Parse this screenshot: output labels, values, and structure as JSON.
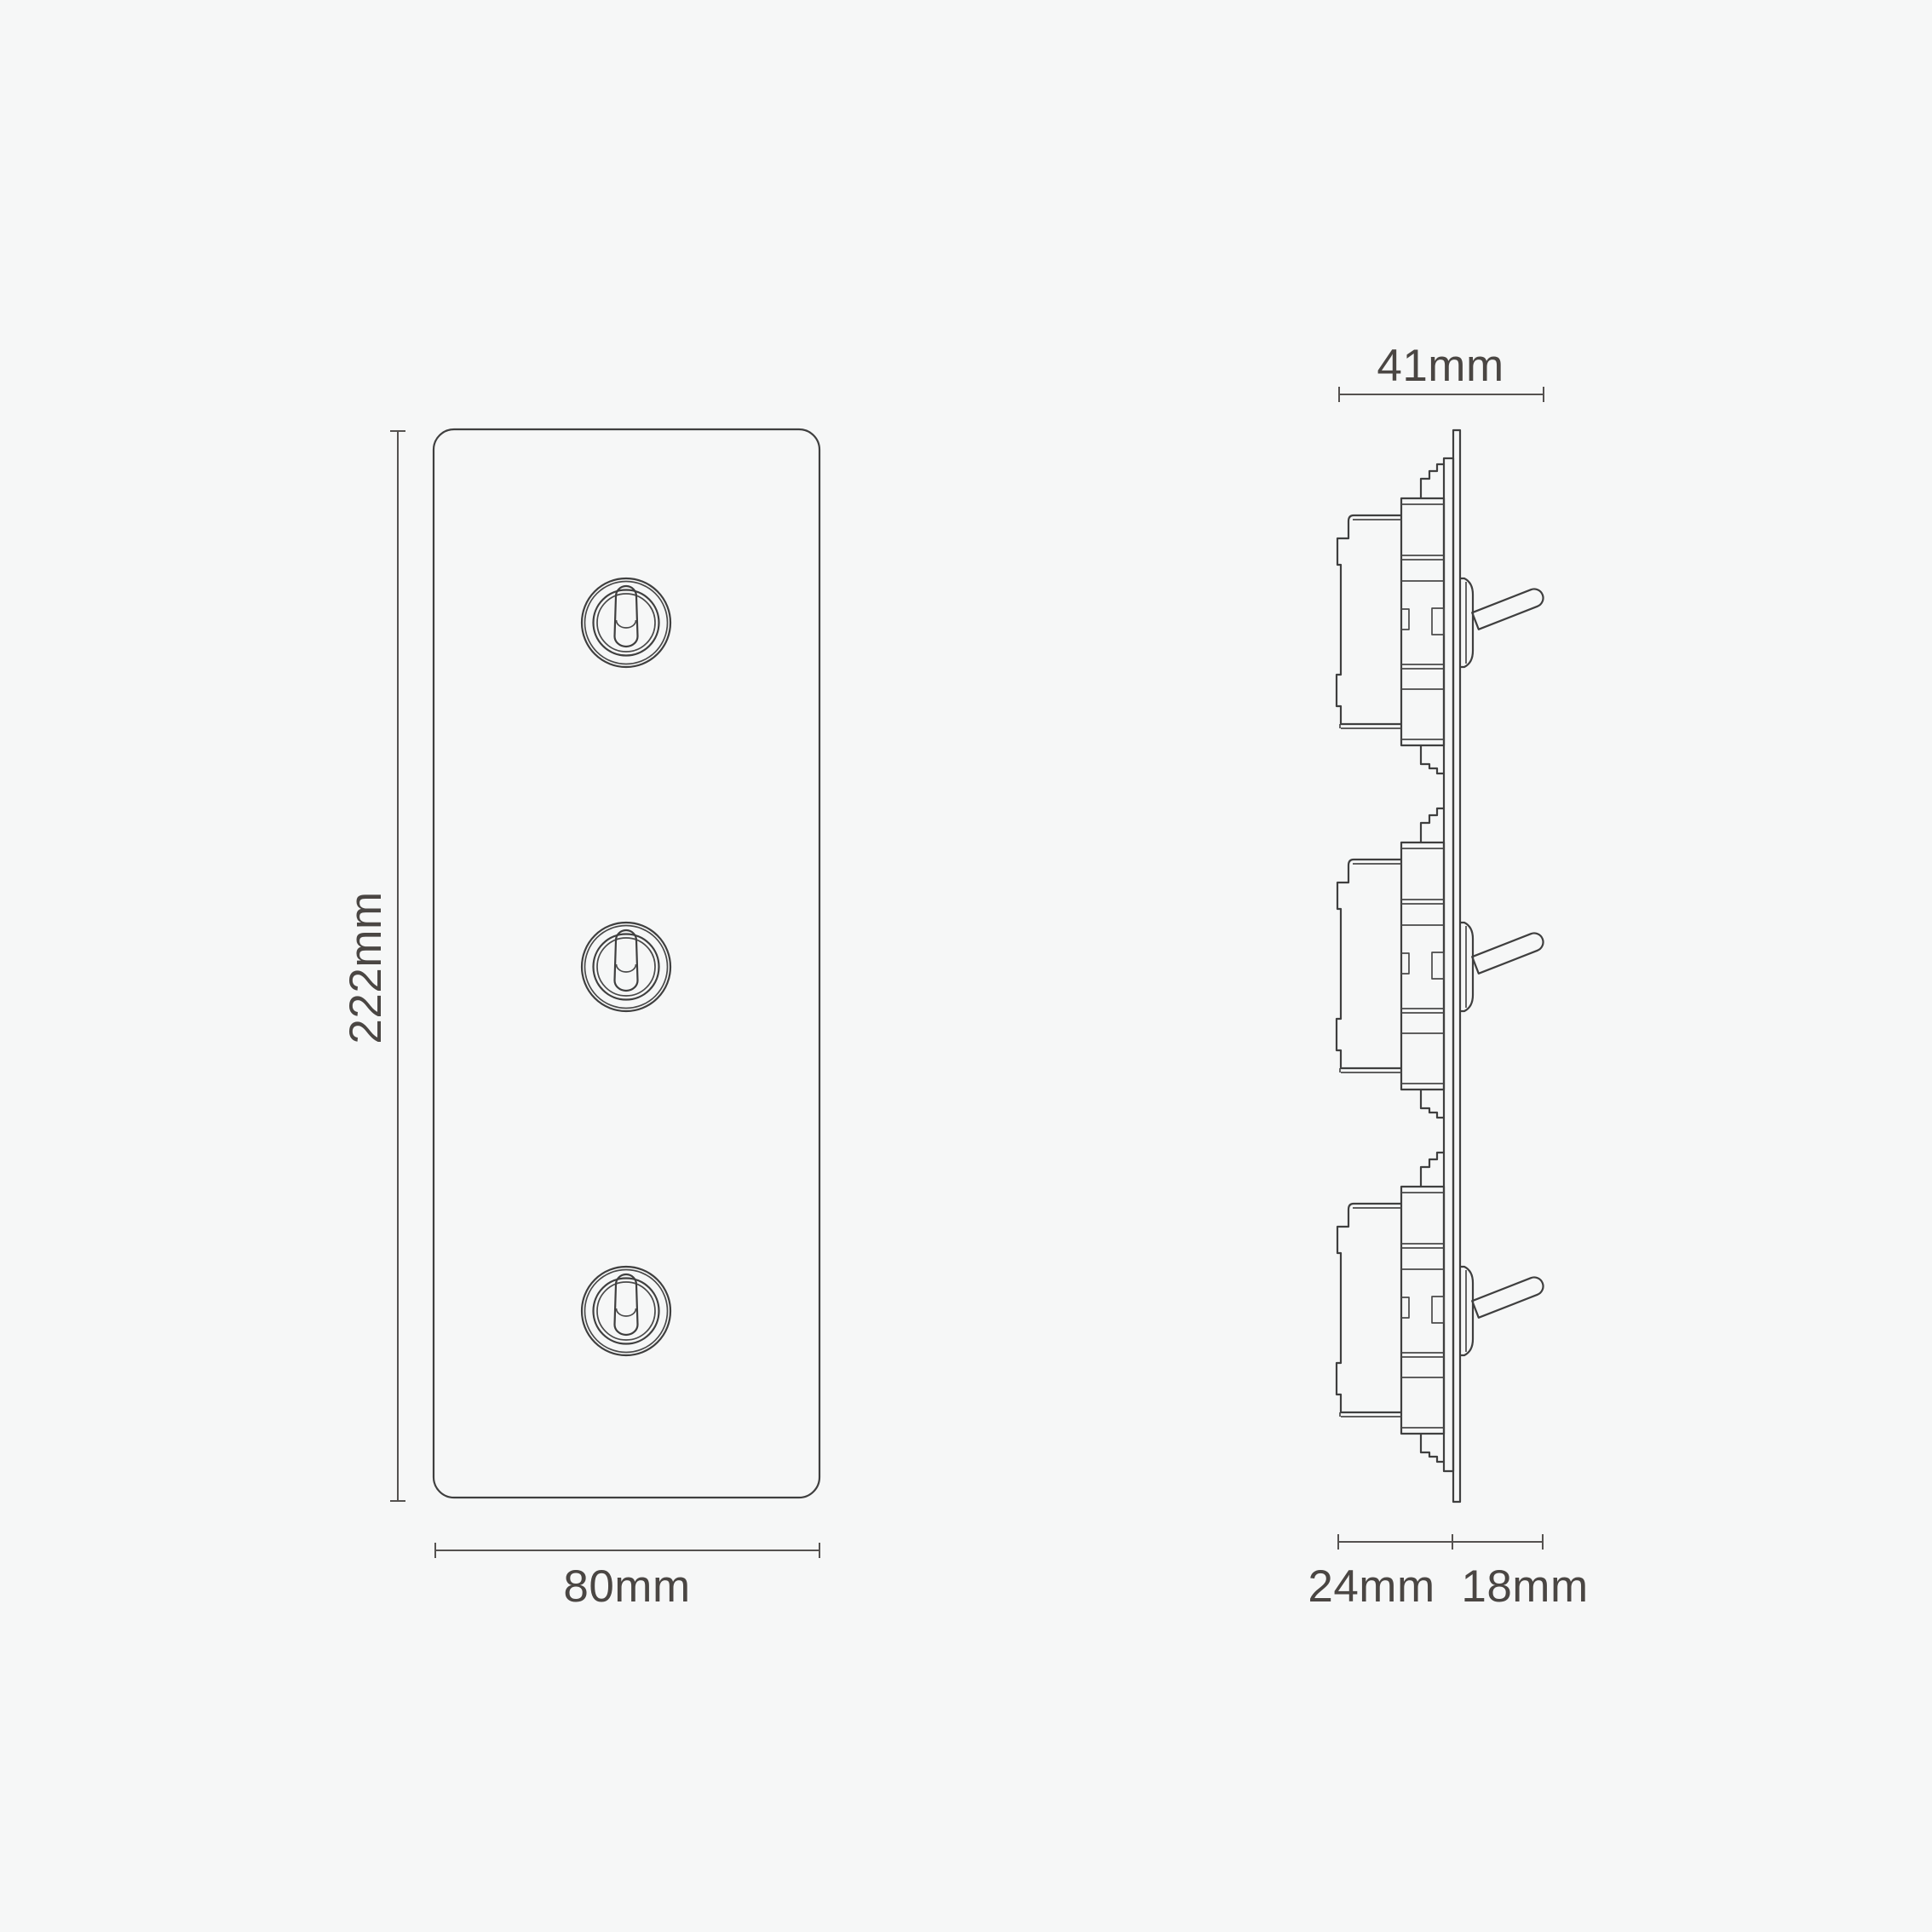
{
  "diagram": {
    "background_color": "#f6f7f7",
    "line_color": "#3f3f3f",
    "text_color": "#4a4643",
    "front_view": {
      "height_label": "222mm",
      "width_label": "80mm",
      "toggle_count": 3
    },
    "side_view": {
      "width_label": "41mm",
      "depth_back_label": "24mm",
      "depth_front_label": "18mm",
      "module_count": 3
    }
  }
}
